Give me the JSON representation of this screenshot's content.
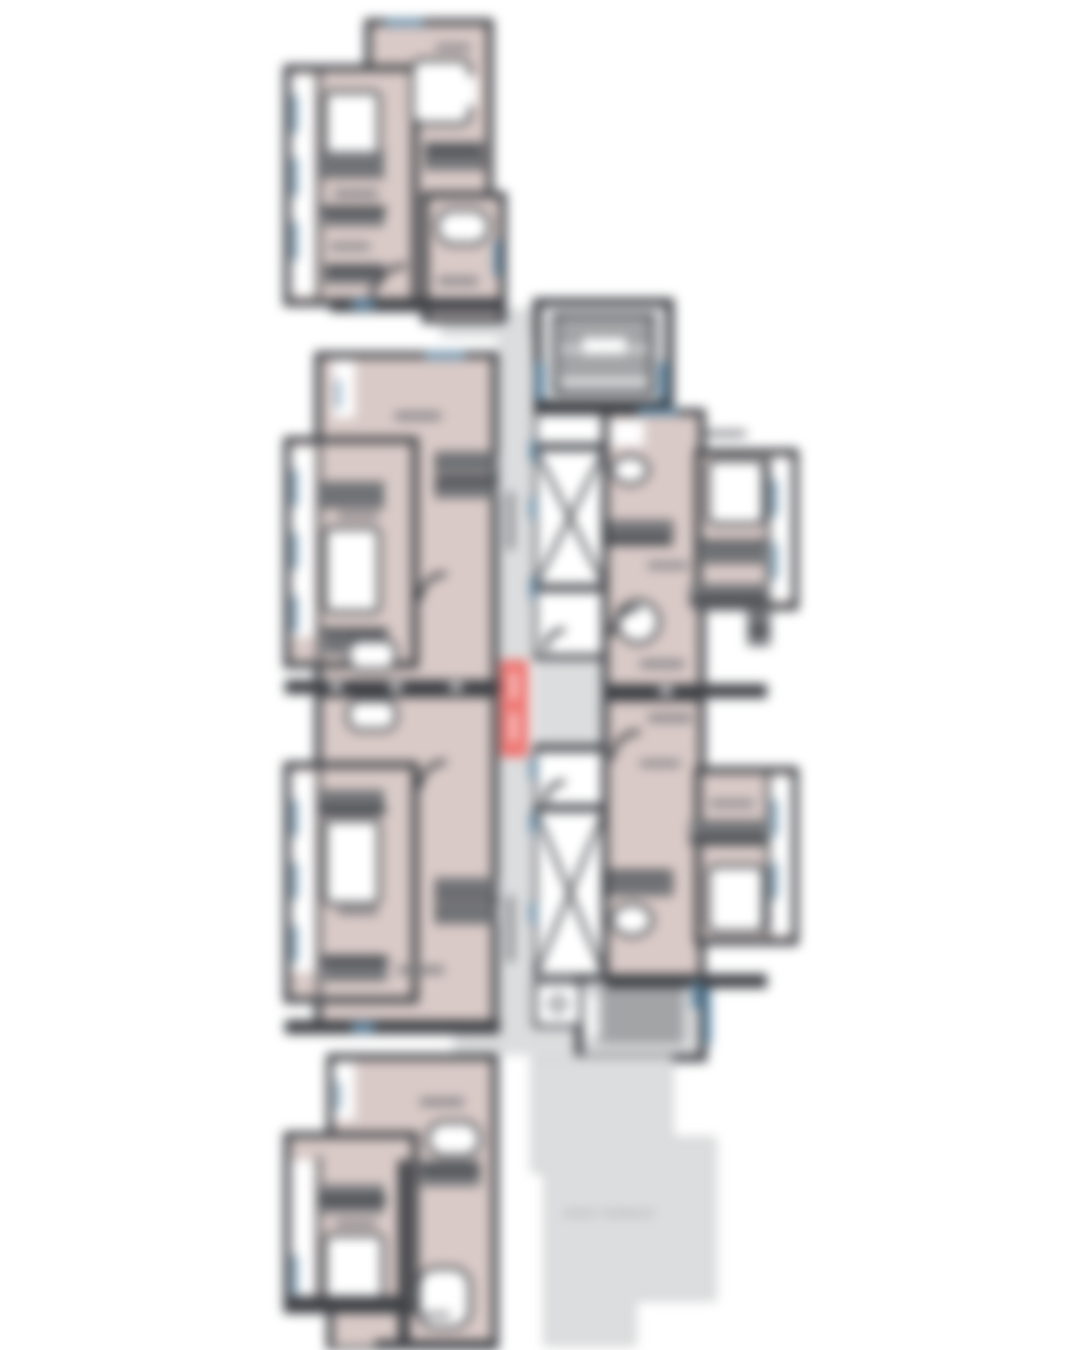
{
  "document": {
    "kind": "residential-tower-floor-plan",
    "orientation": "portrait",
    "background": "#ffffff"
  },
  "labels": {
    "open_terrace": "OPEN TERRACE"
  },
  "colors": {
    "wall_dark": "#3d4045",
    "unit_floor_pink": "#d9cac7",
    "common_area_gray": "#dcddde",
    "window_blue": "#5d89a8",
    "refuge_marker_red": "#ee7470",
    "fixture_white": "#ffffff",
    "label_smudge_gray": "#77787c"
  },
  "features": {
    "apartment_units_visible": 6,
    "lift_shafts": 4,
    "stair_blocks": 2,
    "corridor": "central vertical",
    "terrace": "bottom right L-shaped"
  }
}
